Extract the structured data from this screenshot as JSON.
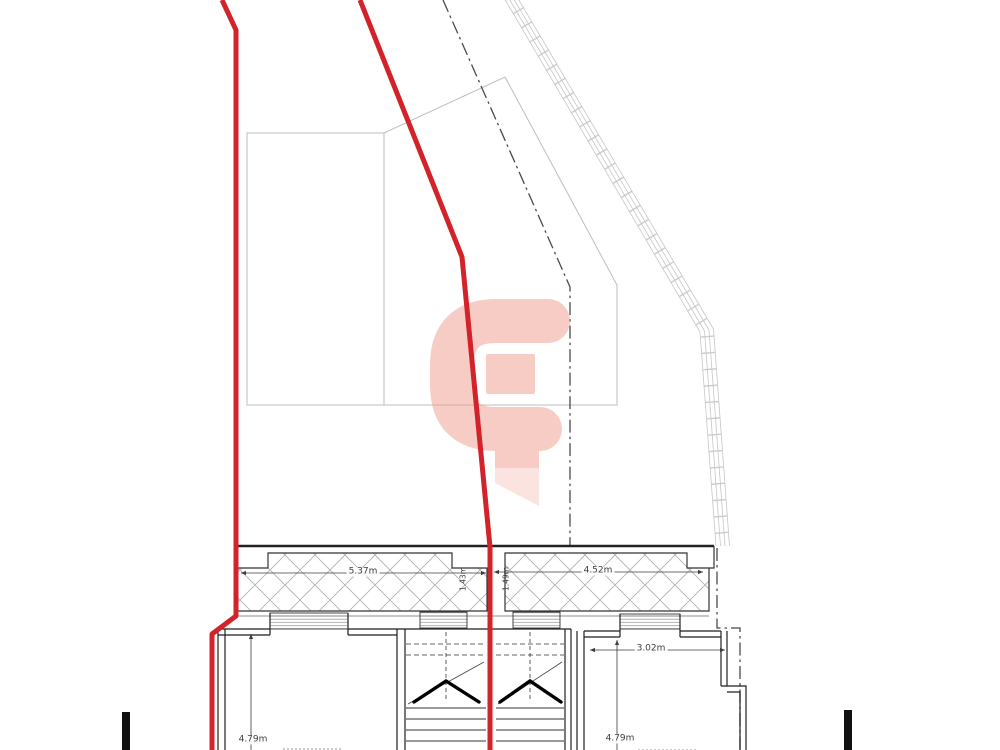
{
  "drawing": {
    "dims": {
      "band_left_width": "5.37m",
      "band_right_width": "4.52m",
      "band_left_depth": "1.43m",
      "band_right_depth": "1.49m",
      "right_room_width": "3.02m",
      "left_room_depth": "4.79m",
      "right_room_depth": "4.79m"
    },
    "colors": {
      "boundary_red": "#d2232a",
      "watermark_pink": "#f09a8c",
      "line_black": "#1a1a1a",
      "line_gray": "#bdbdbd"
    }
  }
}
